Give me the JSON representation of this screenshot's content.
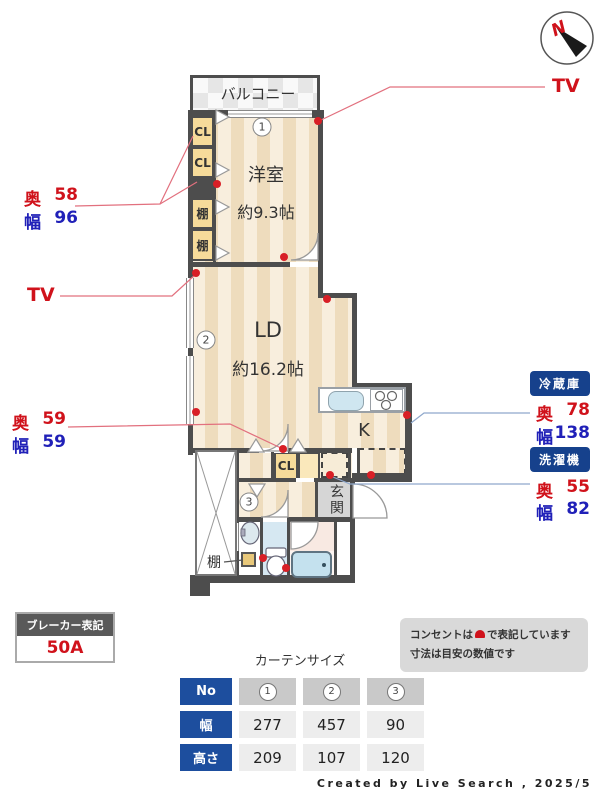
{
  "compass": {
    "north_label": "N"
  },
  "plan": {
    "balcony_label": "バルコニー",
    "western_room": {
      "name": "洋室",
      "size": "約9.3帖"
    },
    "living_dining": {
      "name": "LD",
      "size": "約16.2帖"
    },
    "kitchen_label": "K",
    "entrance_label": "玄関",
    "closets": {
      "cl1": "CL",
      "cl2": "CL",
      "shelf1": "棚",
      "shelf2": "棚",
      "cl_lower": "CL",
      "shelf_lower": "棚"
    },
    "markers": {
      "m1": "1",
      "m2": "2",
      "m3": "3"
    }
  },
  "annotations": {
    "tv_top": "TV",
    "tv_left": "TV",
    "closet_upper": {
      "depth_label": "奥",
      "depth": "58",
      "width_label": "幅",
      "width": "96"
    },
    "closet_lower": {
      "depth_label": "奥",
      "depth": "59",
      "width_label": "幅",
      "width": "59"
    }
  },
  "appliances": {
    "fridge": {
      "title": "冷蔵庫",
      "depth_label": "奥",
      "depth": "78",
      "width_label": "幅",
      "width": "138"
    },
    "washer": {
      "title": "洗濯機",
      "depth_label": "奥",
      "depth": "55",
      "width_label": "幅",
      "width": "82"
    }
  },
  "breaker": {
    "title": "ブレーカー表記",
    "value": "50A"
  },
  "curtain_table": {
    "title": "カーテンサイズ",
    "no_label": "No",
    "col_headers": [
      "1",
      "2",
      "3"
    ],
    "rows": [
      {
        "label": "幅",
        "values": [
          "277",
          "457",
          "90"
        ]
      },
      {
        "label": "高さ",
        "values": [
          "209",
          "107",
          "120"
        ]
      }
    ]
  },
  "note": {
    "line1_pre": "コンセントは",
    "line1_post": "で表記しています",
    "line2": "寸法は目安の数値です"
  },
  "credit": "Created by Live Search , 2025/5",
  "colors": {
    "accent_red": "#d0121b",
    "accent_blue": "#2020b8",
    "badge_navy": "#16418c",
    "table_blue": "#1d4e9e",
    "wall": "#4d4d4d",
    "floor_stripe_light": "#f8eedd",
    "floor_stripe_dark": "#eedcbd"
  }
}
